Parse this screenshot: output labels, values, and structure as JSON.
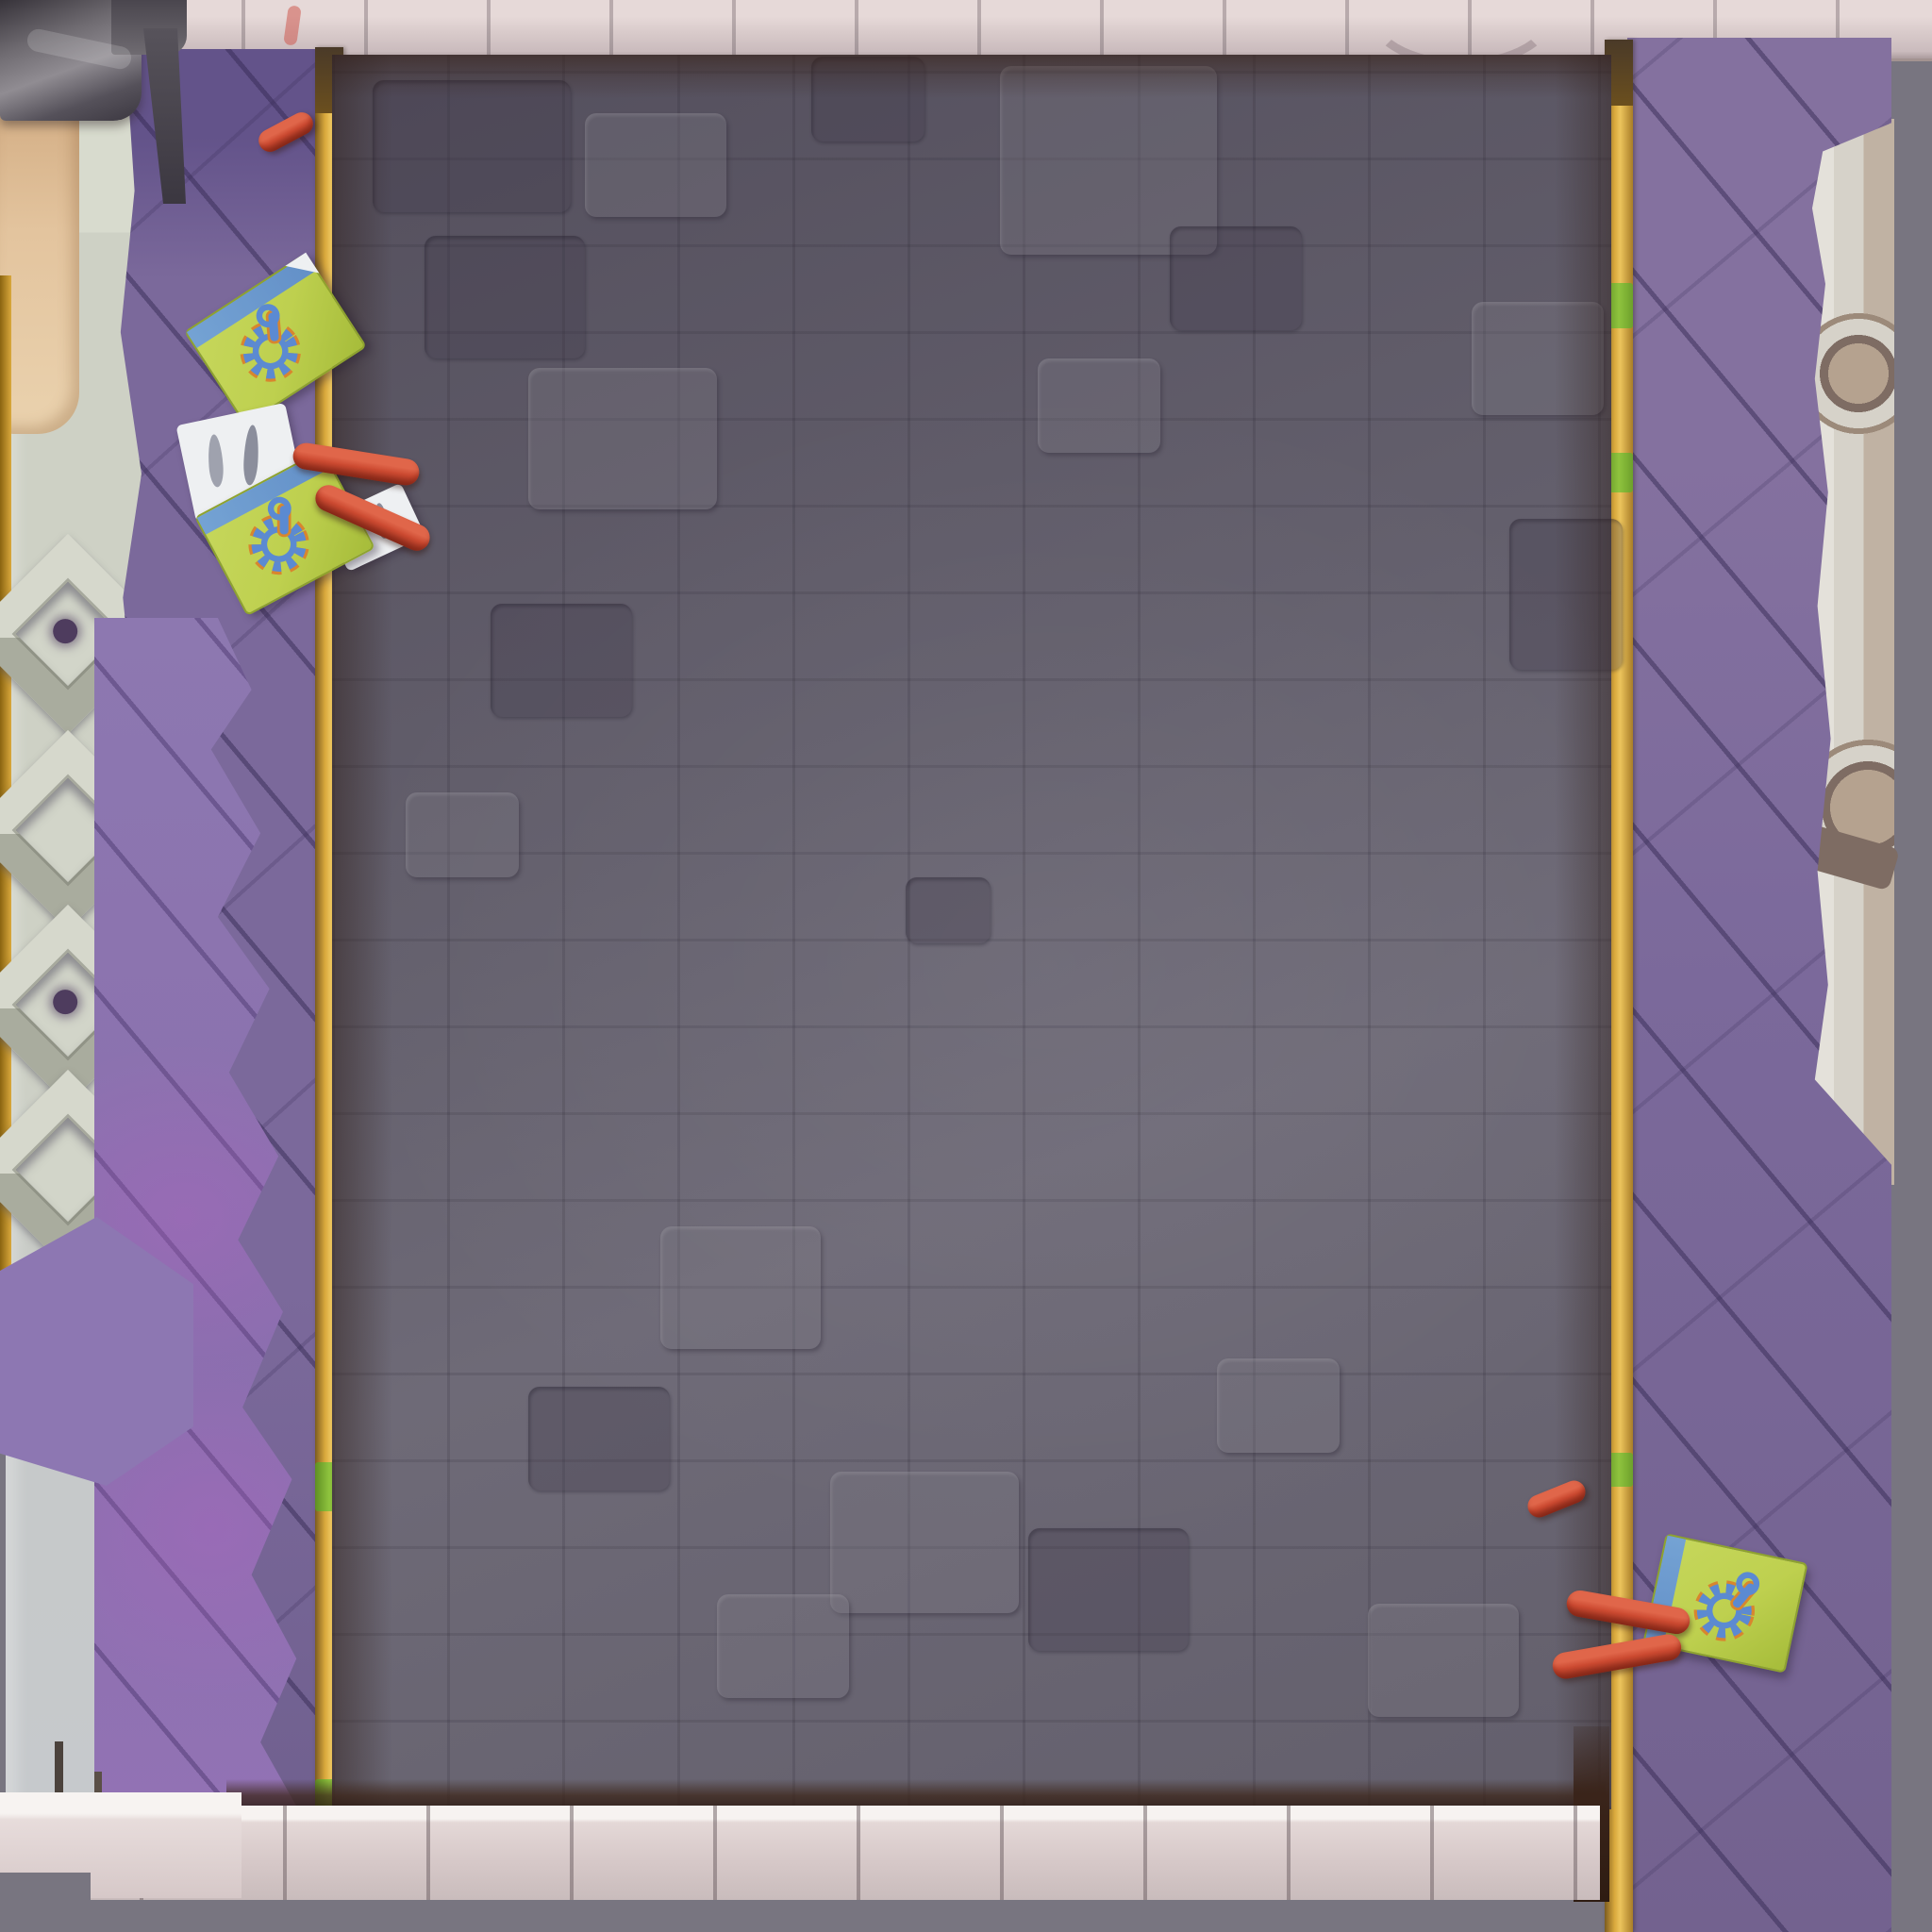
{
  "scene": {
    "title": "Hand-painted top-down arena map tile",
    "description": "Dark cobblestone floor bordered by purple diagonal-plank ramps with gold trim rails, light stone ledges at top and bottom, carved stone lattice on the right edge, metal pipe and planter column on the left",
    "view": "top-down",
    "art_style": "stylized hand-painted game environment"
  },
  "palette": {
    "border_gray": "#787580",
    "top_band": "#d9cbcb",
    "floor_base": "#635f6c",
    "floor_light": "#6e6a77",
    "floor_dark": "#544f5d",
    "wall_purple": "#7b699b",
    "wall_purple_dark": "#63538a",
    "wall_purple_bright": "#8d77b2",
    "trim_gold": "#d9a83c",
    "trim_gold_light": "#ecc45c",
    "trim_gold_dark": "#7c5c20",
    "trim_green": "#8fc43e",
    "tan_wall": "#e3c49e",
    "tan_dark": "#cfa87e",
    "pipe_gray": "#6f6b71",
    "pipe_light": "#908c92",
    "pipe_dark": "#3b3740",
    "column_light": "#ced1c5",
    "column_blue": "#c6c9cc",
    "ledge_light": "#d6c8c8",
    "ledge_highlight": "#f7f3f1",
    "ledge_shadow": "#c9bcbc",
    "lattice_bone": "#d6d2c9",
    "lattice_tan": "#b5a28f",
    "lattice_recess": "#7e6c63",
    "card_green": "#bed04f",
    "card_blue": "#5b8ad2",
    "card_orange": "#d8862e",
    "paper_white": "#eef0f2",
    "sausage_red": "#cc4a31",
    "sausage_dark": "#93301f",
    "diamond_face": "#d6d8cc",
    "diamond_dark": "#a9ac9e",
    "diamond_hole": "#4e3c5e"
  },
  "objects": {
    "ticket_cards": [
      {
        "id": "card-left-1",
        "emblem": "gear-and-wrench",
        "rotation_deg": -33
      },
      {
        "id": "card-left-2",
        "emblem": "gear-and-wrench",
        "rotation_deg": -28
      },
      {
        "id": "card-right",
        "emblem": "gear-and-wrench",
        "rotation_deg": 12
      }
    ],
    "paper_scraps": 2,
    "sausages": 6,
    "diamond_planters": 4,
    "lattice_rosettes": 2,
    "gold_trim_rails": 2
  }
}
